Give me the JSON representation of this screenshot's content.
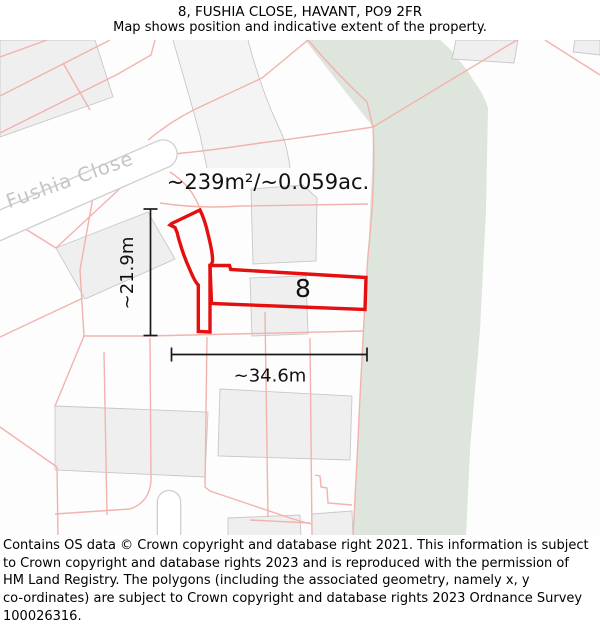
{
  "header": {
    "title": "8, FUSHIA CLOSE, HAVANT, PO9 2FR",
    "subtitle": "Map shows position and indicative extent of the property."
  },
  "map": {
    "street_label": "Fushia Close",
    "plot_number": "8",
    "area_label": "~239m²/~0.059ac.",
    "dim_vertical_label": "~21.9m",
    "dim_horizontal_label": "~34.6m",
    "colors": {
      "outline_red": "#e60f0f",
      "parcel_pink": "#f2b3ac",
      "building_fill": "#efeff0",
      "building_stroke": "#c8c8c8",
      "green_fill": "#dee5dd",
      "street_stroke": "#cfcfcf",
      "street_fill": "#ffffff",
      "street_label_color": "#c5c5c5",
      "dimension_color": "#1a1a1a",
      "tint_fill": "#f4f4f4",
      "background": "#fdfdfd"
    },
    "geometry": {
      "green": "M305,0 L440,0 Q452,10 457,18 Q468,30 473,40 Q484,54 488,68 L486,170 L480,290 L470,410 L466,497 L353,497 L358,400 L363,290 L368,215 L372,130 L373,87 Z",
      "tint_strip": "M173,0 L248,0 C257,35 267,63 281,92 Q287,105 290,128 L207,128 Q203,110 200,95 C192,65 183,35 173,0 Z",
      "gray_lines": [
        "M173,0 C183,35 192,65 200,95 Q203,110 207,128",
        "M248,0 C257,35 267,63 281,92 Q287,105 290,128"
      ],
      "buildings": [
        "M0,0 L95,0 L113,57 L0,97 Z",
        "M56,208 L148,172 L175,219 L85,259 Z",
        "M251,149 L303,145 L317,158 L316,221 L253,224 Z",
        "M250,238 L306,236 L308,294 L252,296 Z",
        "M456,0 L518,0 L514,23 L452,19 Z",
        "M575,0 L600,0 L600,15 L573,12 Z",
        "M55,366 L208,372 L205,437 L55,430 Z",
        "M220,349 L352,356 L350,420 L218,416 Z",
        "M228,478 L300,475 L301,497 L228,497 Z",
        "M312,474 L352,471 L353,497 L312,497 Z"
      ],
      "parcel_lines": [
        "M0,17 L47,0",
        "M0,56 L110,0",
        "M63,23 L90,70",
        "M155,0 L151,15 L118,34 L0,93",
        "M308,0 L262,38 L202,66 Q175,78 148,100",
        "M308,0 Q335,32 367,62 L373,87",
        "M373,87 L517,0",
        "M545,0 L600,35",
        "M373,87 Q300,98 260,103 Q215,110 174,114",
        "M170,132 Q192,146 200,169",
        "M160,163 Q200,169 240,166 L368,164",
        "M95,146 L80,230 L84,296",
        "M141,129 L56,208",
        "M0,173 L56,208",
        "M83,258 L0,297",
        "M373,87 Q376,140 368,215 Q363,290 358,400 L353,497",
        "M148,296 L363,291",
        "M84,296 L148,296",
        "M84,296 L55,366",
        "M0,387 L57,427",
        "M57,427 L58,497",
        "M104,312 L107,475",
        "M150,298 L151,440 Q150,462 130,469 L55,474",
        "M207,297 L205,447 L210,451 L293,479 L311,484",
        "M265,272 L268,477",
        "M310,298 L312,497",
        "M315,435 L320,436 L321,447 L327,448 L328,463 L352,465",
        "M250,480 L310,483"
      ],
      "streets": [
        {
          "d": "M-45,205 L163,114",
          "width": 27
        },
        {
          "d": "M169,462 L169,508",
          "width": 22
        }
      ],
      "property_outline": [
        "M200,170 C203,176 206,185 208,194 C210,202 212.5,212 212.5,219 Q213,223 210,225.5 L210,292 L198.3,291.5 L198.3,245 Q195,242 190,230 Q184,217 180,203 Q178,197 177.3,193 L175,187.5 L170,185 L171.7,183.5 Z",
        "M210,225.5 L229.5,225.5 L230.7,229.5 L366,237.5 L365,269.5 L211.5,263.5 Z"
      ],
      "dimension_lines": [
        "M150.5,169 L150.5,295.5",
        "M143.5,169 L157.5,169",
        "M143.5,295.5 L157.5,295.5",
        "M171.5,314.5 L367,314.5",
        "M171.5,307.5 L171.5,321.5",
        "M367,307.5 L367,321.5"
      ]
    }
  },
  "footer": {
    "lines": [
      "Contains OS data © Crown copyright and database right 2021. This information is subject",
      "to Crown copyright and database rights 2023 and is reproduced with the permission of",
      "HM Land Registry. The polygons (including the associated geometry, namely x, y",
      "co-ordinates) are subject to Crown copyright and database rights 2023 Ordnance Survey",
      "100026316."
    ]
  }
}
